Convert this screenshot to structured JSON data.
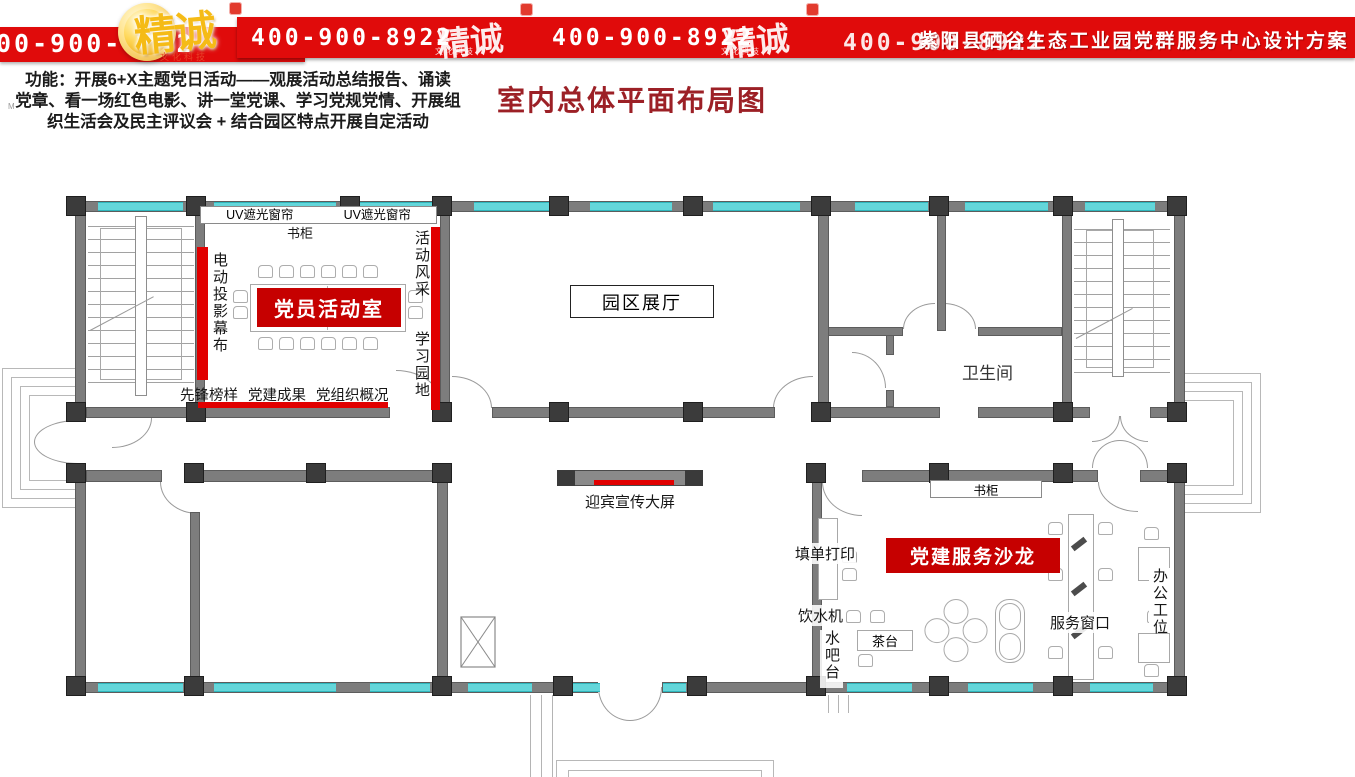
{
  "header": {
    "phone_partial": "00-900-8922",
    "phones": [
      "400-900-8922",
      "400-900-8922",
      "400-900-8922"
    ],
    "brand": "精诚",
    "brand_sub": "文化科技",
    "title": "紫阳县硒谷生态工业园党群服务中心设计方案"
  },
  "intro": {
    "line1": "功能：开展6+X主题党日活动——观展活动总结报告、诵读",
    "line2": "党章、看一场红色电影、讲一堂党课、学习党规党情、开展组",
    "line3": "织生活会及民主评议会 +  结合园区特点开展自定活动",
    "mark": "M"
  },
  "page_title": "室内总体平面布局图",
  "plan": {
    "rooms": {
      "activity_room": "党员活动室",
      "exhibition_hall": "园区展厅",
      "restroom": "卫生间",
      "salon": "党建服务沙龙"
    },
    "labels": {
      "uv_curtain_left": "UV遮光窗帘",
      "uv_curtain_right": "UV遮光窗帘",
      "bookcase_top": "书柜",
      "projector_screen": "电动投影幕布",
      "activity_showcase": "活动风采",
      "learning_corner": "学习园地",
      "pioneer_models": "先锋榜样",
      "party_achievements": "党建成果",
      "party_org_overview": "党组织概况",
      "welcome_screen": "迎宾宣传大屏",
      "bookcase_salon": "书柜",
      "form_printing": "填单打印",
      "water_dispenser": "饮水机",
      "water_bar": "水吧台",
      "tea_table": "茶台",
      "service_window": "服务窗口",
      "office_workstation": "办公工位"
    },
    "colors": {
      "banner_red": "#e00b0b",
      "accent_red": "#c60000",
      "title_maroon": "#9c2026",
      "wall_gray": "#7d7d7d",
      "column_dark": "#3b3b3b",
      "window_cyan": "#63d6da"
    }
  }
}
